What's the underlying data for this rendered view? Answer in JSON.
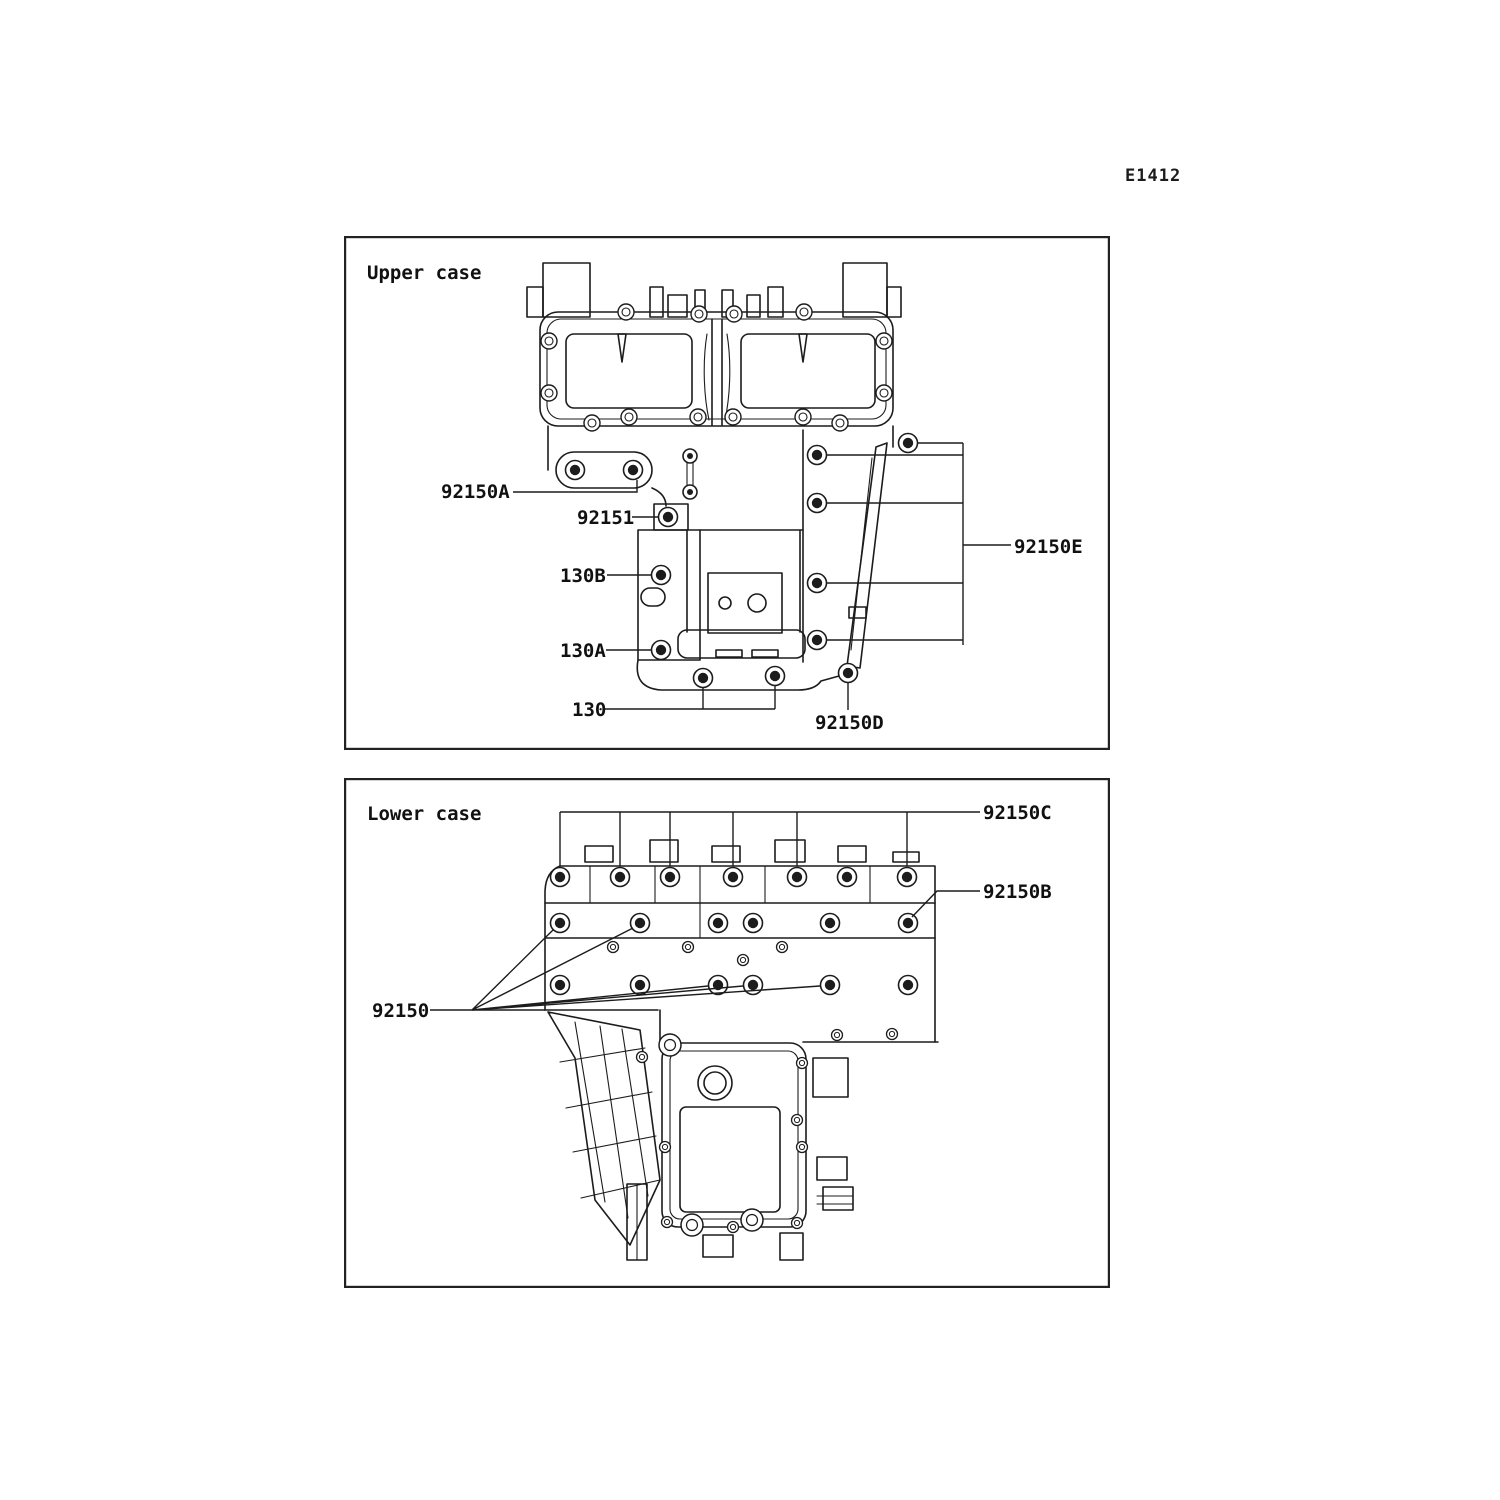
{
  "document": {
    "code": "E1412",
    "background_color": "#ffffff",
    "ink_color": "#1c1c1c",
    "description": "Crankcase bolt pattern diagram, upper and lower case views"
  },
  "upper": {
    "title": "Upper case",
    "labels": {
      "b92150A": "92150A",
      "b92151": "92151",
      "b130B": "130B",
      "b130A": "130A",
      "b130": "130",
      "b92150D": "92150D",
      "b92150E": "92150E"
    }
  },
  "lower": {
    "title": "Lower case",
    "labels": {
      "b92150C": "92150C",
      "b92150B": "92150B",
      "b92150": "92150"
    }
  }
}
